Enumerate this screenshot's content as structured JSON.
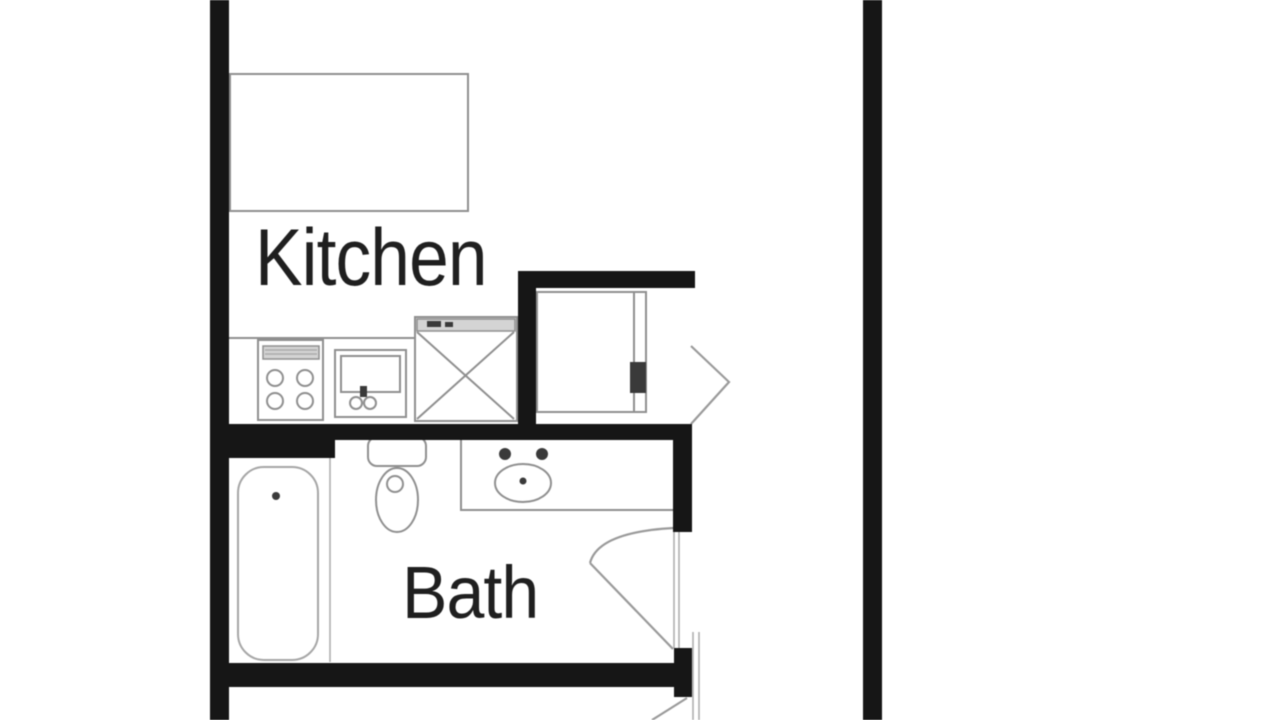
{
  "floorplan": {
    "rooms": [
      {
        "id": "kitchen",
        "label": "Kitchen"
      },
      {
        "id": "bath",
        "label": "Bath"
      }
    ],
    "colors": {
      "background": "#ffffff",
      "wall": "#161616",
      "fixture_line": "#8f8f8f",
      "fixture_fill": "#d4d4d4",
      "label_text": "#1f1f1f"
    },
    "fixtures": [
      "kitchen-island-counter",
      "stove-4-burner",
      "kitchen-sink",
      "appliance-x-box",
      "refrigerator-closet",
      "kitchen-door-swing",
      "bathtub",
      "toilet",
      "vanity-counter",
      "bathroom-sink",
      "bath-door-swing",
      "lower-room-door-swing"
    ]
  }
}
